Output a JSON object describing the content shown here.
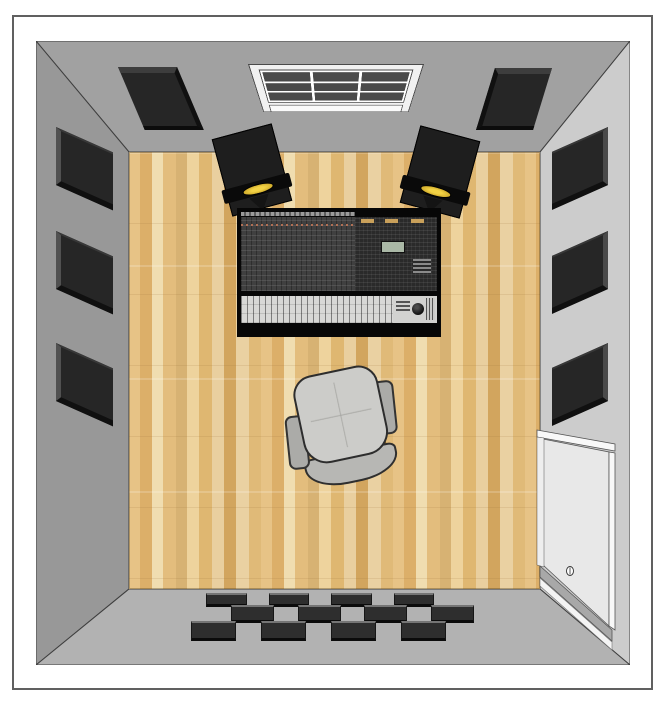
{
  "scene": {
    "name": "recording-studio-control-room-top-view",
    "room": {
      "wall_colors": {
        "top": "#a1a1a1",
        "left": "#989898",
        "right": "#cccccc",
        "bottom": "#b2b2b2"
      },
      "outline_color": "#3f3f3f",
      "floor_wood_colors": [
        "#e7c386",
        "#dcaf69",
        "#f0ddb0",
        "#d7b273",
        "#eed39d",
        "#d2a55e"
      ],
      "border_color": "#606060"
    },
    "objects": {
      "window": {
        "pane_columns": 3,
        "pane_rows": 3,
        "frame_color": "#f1f1f1",
        "pane_color": "#4a4a4a"
      },
      "acoustic_panels": {
        "left_wall_count": 3,
        "right_wall_count": 3,
        "top_wall_count": 2,
        "color": "#262626"
      },
      "studio_monitors": {
        "count": 2,
        "body_color": "#1e1e1e",
        "tweeter_color": "#d8b430",
        "toe_in_degrees": 15
      },
      "mixing_console": {
        "base_color": "#070707",
        "channel_section_color": "#3a3a3a",
        "fader_section_color": "#d8d8d6",
        "lcd_color": "#aab8a6",
        "button_chip_color": "#c9a05a"
      },
      "office_chair": {
        "seat_color": "#ccccc9",
        "backrest_color": "#b7b7b4",
        "armrest_color": "#ababa8",
        "wood_accent_color": "#c2913c"
      },
      "door": {
        "leaf_color": "#e8e8e8",
        "frame_color": "#f8f8f8",
        "trim_color": "#a8a8a8",
        "has_knob": true
      },
      "diffuser_tiles": {
        "rows": 3,
        "columns": 8,
        "pattern": "checkerboard",
        "tile_color": "#2e2e2e"
      }
    }
  }
}
